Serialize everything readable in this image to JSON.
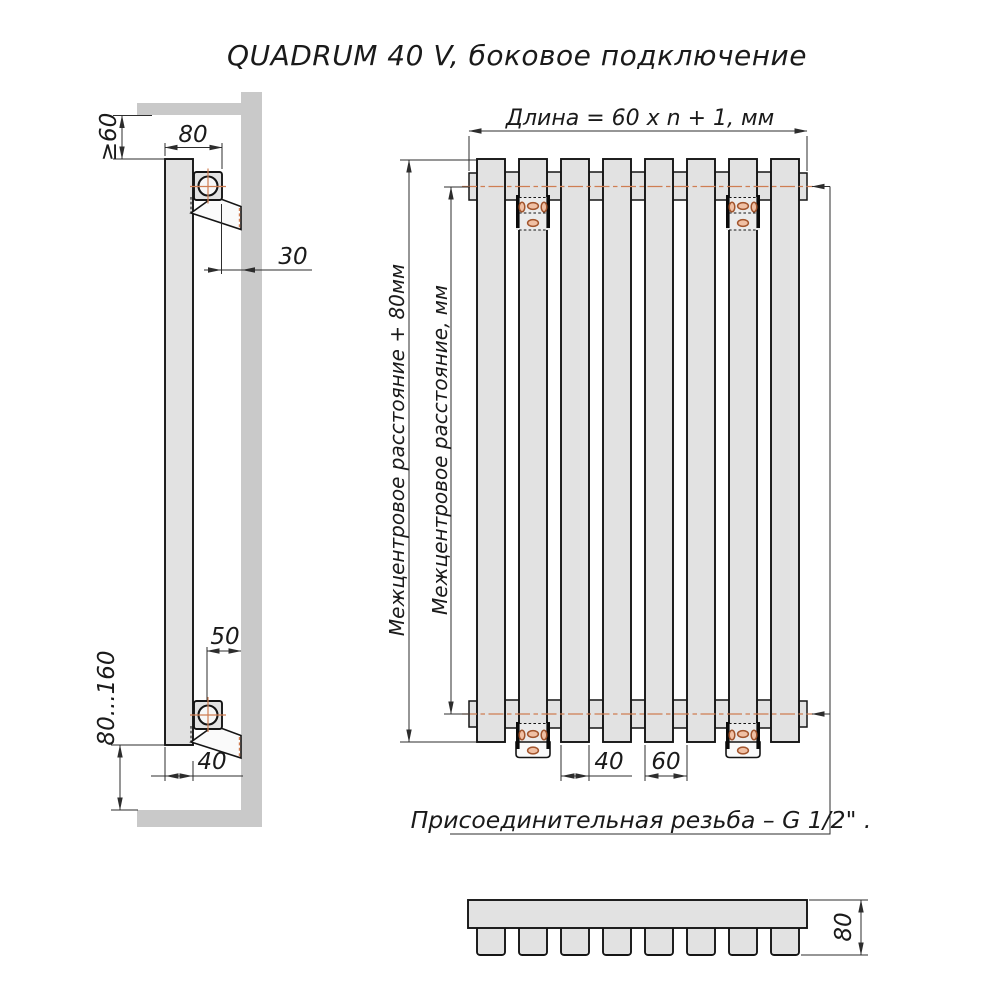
{
  "title": "QUADRUM 40 V, боковое подключение",
  "side_view": {
    "wall_offset_top": "≥60",
    "depth_total": "80",
    "wall_gap": "30",
    "bracket_to_wall": "50",
    "tube_depth": "40",
    "floor_clearance": "80...160"
  },
  "front_view": {
    "length_formula": "Длина = 60 x n + 1, мм",
    "center_distance_outer": "Межцентровое расстояние + 80мм",
    "center_distance_inner": "Межцентровое расстояние, мм",
    "tube_width": "40",
    "tube_pitch": "60",
    "thread_note": "Присоединительная резьба – G 1/2\" ."
  },
  "top_view": {
    "depth": "80"
  },
  "colors": {
    "background": "#ffffff",
    "wall_gray": "#c9c9c9",
    "metal_fill": "#e2e2e2",
    "outline": "#151515",
    "dimension": "#2d2d2d",
    "centerline_orange": "#cf7e53",
    "bracket_hole": "#a2542c"
  }
}
